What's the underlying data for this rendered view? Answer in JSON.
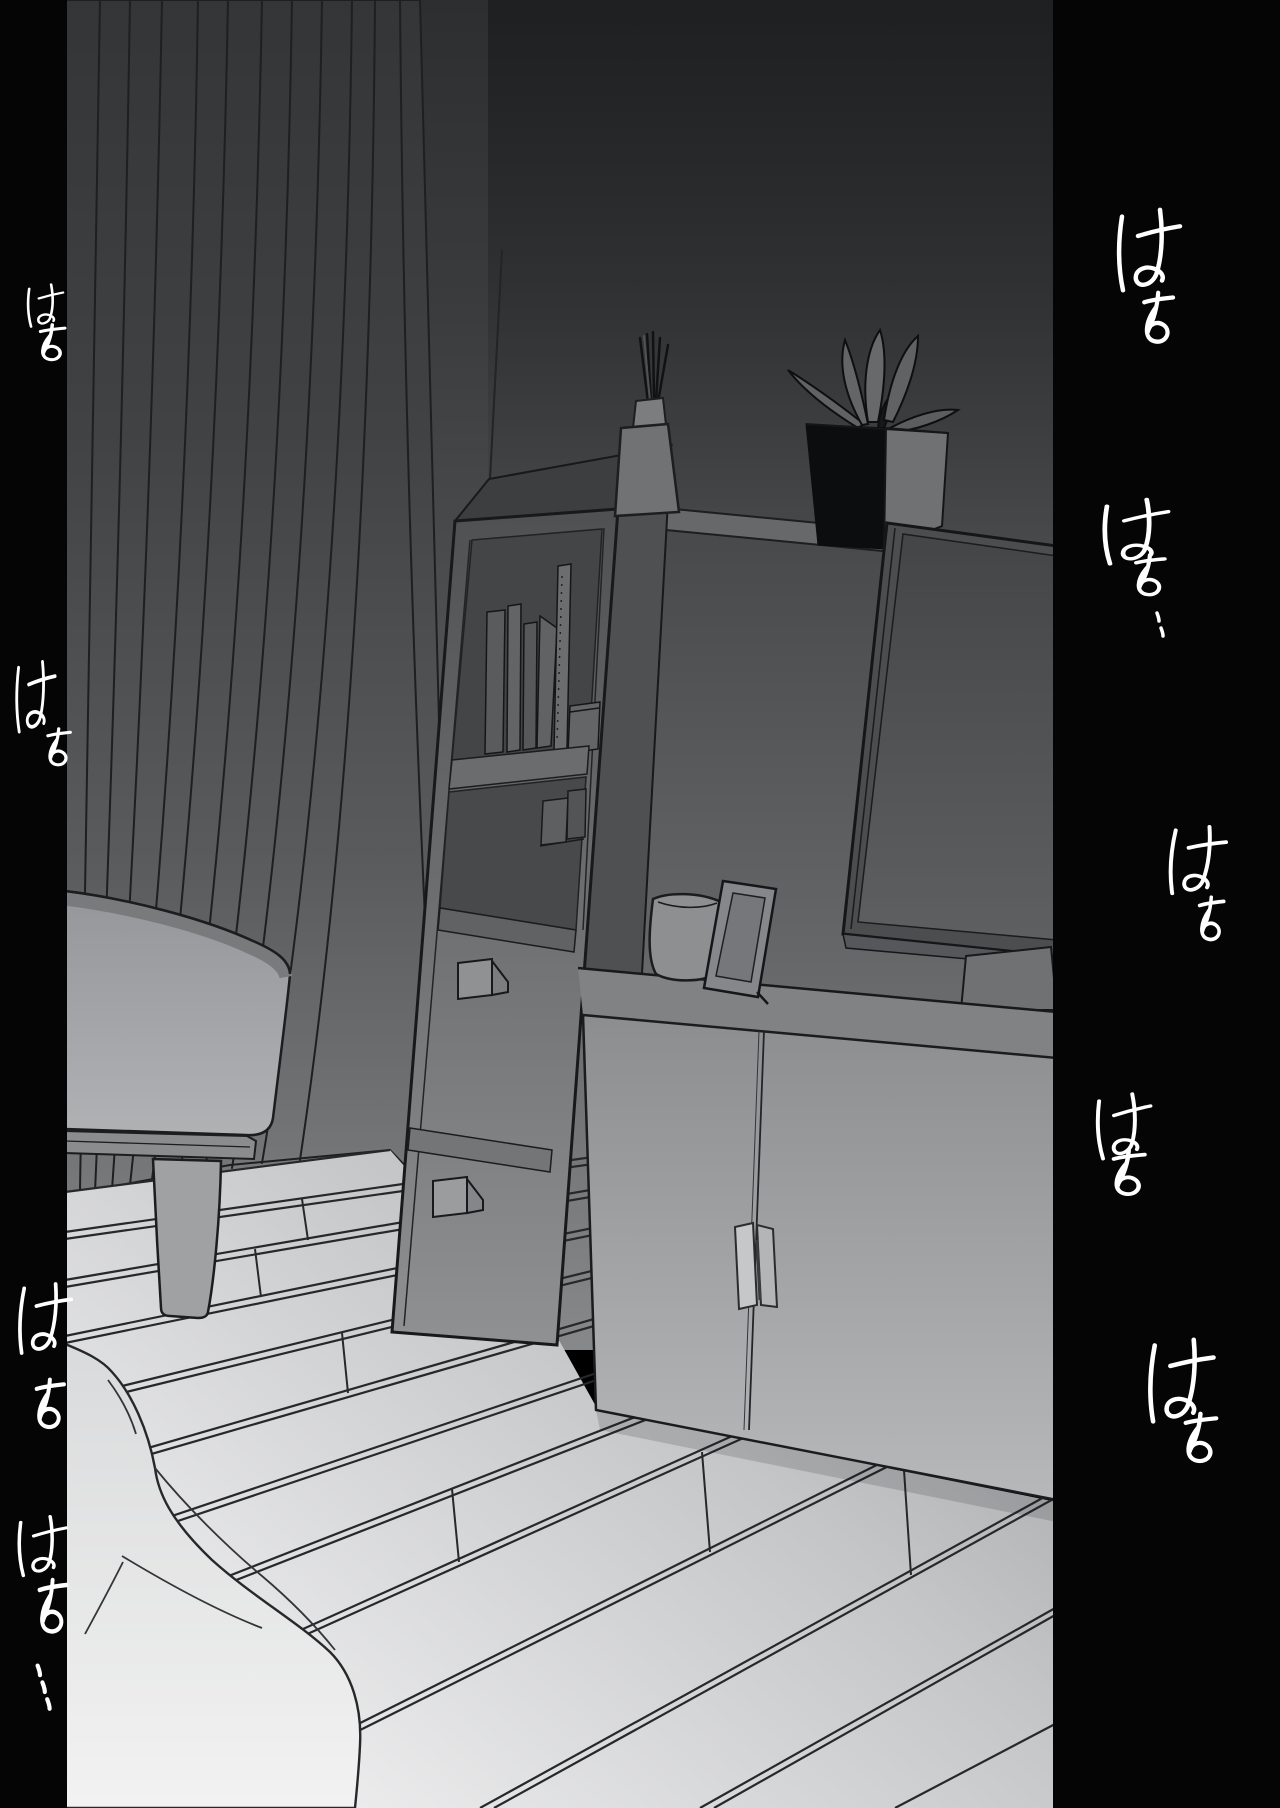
{
  "canvas": {
    "width": 1280,
    "height": 1808,
    "kind": "comic-page"
  },
  "colors": {
    "gutter_black": "#050505",
    "sfx_ink": "#ffffff",
    "line_ink": "#1b1d1f",
    "wall_top": "#2c2e30",
    "wall_bottom": "#86888a",
    "floor_light": "#efefef",
    "plant_pot_shadow": "#0c0d0e"
  },
  "sfx": [
    {
      "id": "right-1",
      "side": "right",
      "text": "はぁ"
    },
    {
      "id": "right-2",
      "side": "right",
      "text": "はぁ‥"
    },
    {
      "id": "right-3",
      "side": "right",
      "text": "はぁ"
    },
    {
      "id": "right-4",
      "side": "right",
      "text": "はぁ"
    },
    {
      "id": "right-5",
      "side": "right",
      "text": "はぁ"
    },
    {
      "id": "left-1",
      "side": "left",
      "text": "はぁ"
    },
    {
      "id": "left-2",
      "side": "left",
      "text": "はぁ"
    },
    {
      "id": "left-3",
      "side": "left",
      "text": "はぁ"
    },
    {
      "id": "left-4",
      "side": "left",
      "text": "はぁ…"
    }
  ],
  "scene": {
    "objects": [
      "curtain",
      "sofa",
      "bookshelf",
      "books",
      "drawers",
      "sideboard-cabinet",
      "tv",
      "tv-stand",
      "potted-plant",
      "reed-diffuser",
      "vase",
      "photo-frame",
      "wood-slat-floor",
      "blanket"
    ]
  }
}
